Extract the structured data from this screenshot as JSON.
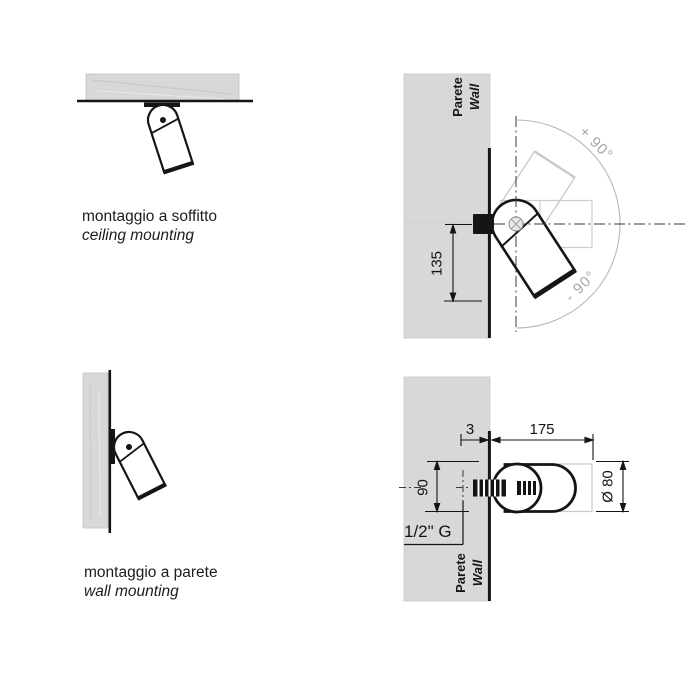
{
  "captions": {
    "ceiling_mounting_it": "montaggio a soffitto",
    "ceiling_mounting_en": "ceiling mounting",
    "wall_mounting_it": "montaggio a parete",
    "wall_mounting_en": "wall mounting"
  },
  "wall_labels": {
    "it": "Parete",
    "en": "Wall"
  },
  "rotation_labels": {
    "plus": "+ 90°",
    "minus": "- 90°"
  },
  "dimensions": {
    "offset_from_axis": "135",
    "plate_thickness": "3",
    "projection": "175",
    "body_height": "90",
    "diameter": "Ø 80",
    "thread": "1/2\" G"
  },
  "colors": {
    "wall_fill": "#d8d8d8",
    "line": "#151515",
    "ghost": "#c9c9c9",
    "angle_text": "#a6a6a6"
  }
}
